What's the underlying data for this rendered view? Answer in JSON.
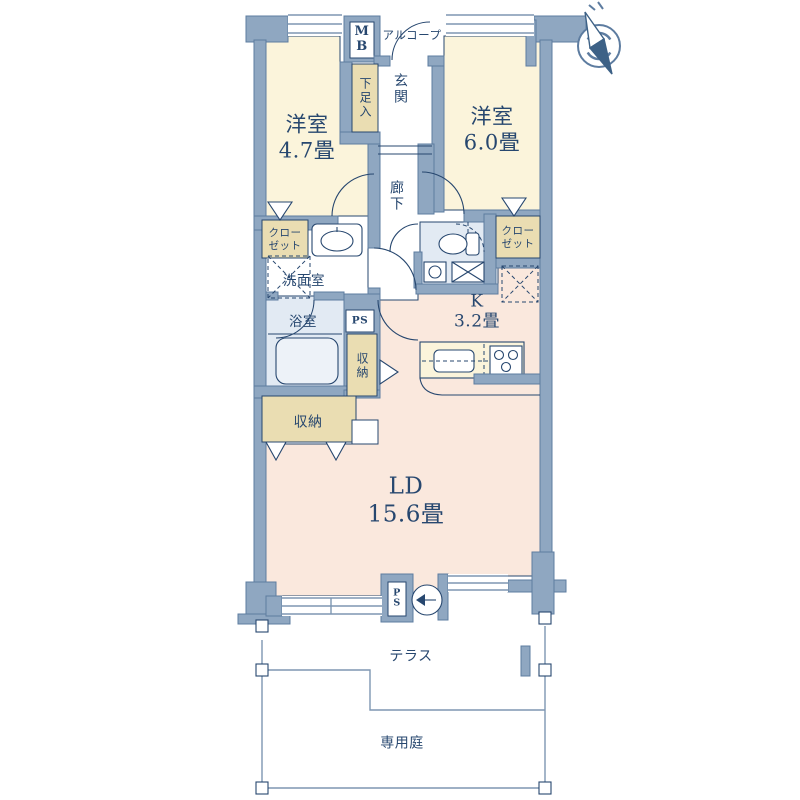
{
  "title": "apartment-floor-plan",
  "labels": {
    "bedroom1": "洋室\n4.7畳",
    "bedroom2": "洋室\n6.0畳",
    "meter_box": "M\nB",
    "alcove": "アルコープ",
    "entrance": "玄関",
    "shoe_box": "下足入",
    "corridor": "廊下",
    "closet_left": "クロー\nゼット",
    "closet_right": "クロー\nゼット",
    "washroom": "洗面室",
    "bathroom": "浴室",
    "pipe_space_mid": "PS",
    "storage_side": "収納",
    "storage_lower": "収納",
    "kitchen": "K\n3.2畳",
    "living_dining": "LD\n15.6畳",
    "pipe_space_bottom": "P\nS",
    "terrace": "テラス",
    "private_garden": "専用庭"
  },
  "icons": {
    "compass": "compass-north-icon",
    "water_heater": "water-heater-icon",
    "bathtub": "bathtub-icon",
    "toilet": "toilet-icon",
    "stove": "gas-stove-icon",
    "sink": "sink-icon"
  },
  "colors": {
    "wall": "#8FA7C1",
    "wallStroke": "#5D7CA0",
    "ink": "#27476F",
    "cream": "#FBF4DB",
    "pink": "#FAE8DD",
    "tan": "#EADDB2",
    "wet": "#E2EAF3",
    "tub": "#EDF2F8",
    "thinLine": "#7E96B2"
  }
}
